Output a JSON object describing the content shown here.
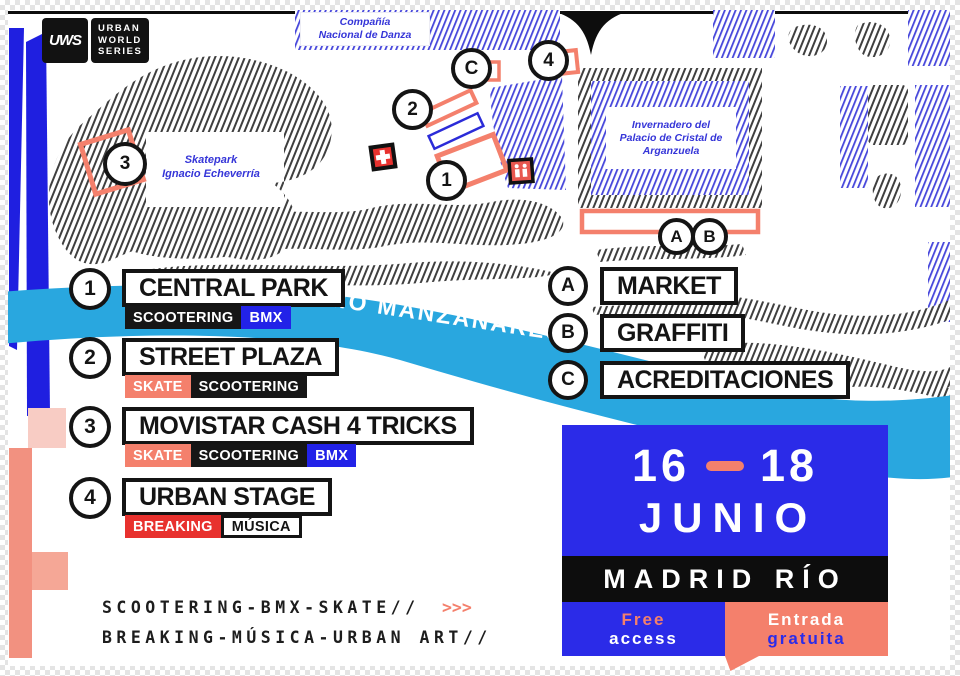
{
  "logo": {
    "monogram": "UWS",
    "line1": "URBAN",
    "line2": "WORLD",
    "line3": "SERIES"
  },
  "map": {
    "labels": {
      "danza": "Compañía\nNacional de Danza",
      "skatepark": "Skatepark\nIgnacio Echeverría",
      "invernadero": "Invernadero del\nPalacio de Cristal de\nArganzuela"
    },
    "markers": {
      "m1": "1",
      "m2": "2",
      "m3": "3",
      "m4": "4",
      "mA": "A",
      "mB": "B",
      "mC": "C"
    },
    "river_label": "RÍO MANZANARES",
    "icons": [
      "medical-cross",
      "restroom"
    ]
  },
  "legend_left": [
    {
      "num": "1",
      "name": "CENTRAL PARK",
      "tags": [
        {
          "label": "SCOOTERING",
          "color": "black"
        },
        {
          "label": "BMX",
          "color": "blue"
        }
      ]
    },
    {
      "num": "2",
      "name": "STREET PLAZA",
      "tags": [
        {
          "label": "SKATE",
          "color": "salmon"
        },
        {
          "label": "SCOOTERING",
          "color": "black"
        }
      ]
    },
    {
      "num": "3",
      "name": "MOVISTAR CASH 4 TRICKS",
      "tags": [
        {
          "label": "SKATE",
          "color": "salmon"
        },
        {
          "label": "SCOOTERING",
          "color": "black"
        },
        {
          "label": "BMX",
          "color": "blue"
        }
      ]
    },
    {
      "num": "4",
      "name": "URBAN STAGE",
      "tags": [
        {
          "label": "BREAKING",
          "color": "red"
        },
        {
          "label": "MÚSICA",
          "color": "white"
        }
      ]
    }
  ],
  "legend_right": [
    {
      "letter": "A",
      "name": "MARKET"
    },
    {
      "letter": "B",
      "name": "GRAFFITI"
    },
    {
      "letter": "C",
      "name": "ACREDITACIONES"
    }
  ],
  "event": {
    "day_start": "16",
    "dash": "–",
    "day_end": "18",
    "month": "JUNIO",
    "location": "MADRID RÍO",
    "free_line1": "Free",
    "free_line2": "access",
    "entry_line1": "Entrada",
    "entry_line2": "gratuita"
  },
  "footer": {
    "line1": "SCOOTERING-BMX-SKATE//",
    "arrows": ">>>",
    "line2": "BREAKING-MÚSICA-URBAN ART//"
  },
  "colors": {
    "blue": "#2B2BE8",
    "salmon": "#F4806C",
    "red": "#E8312E",
    "cyan": "#29A7DF",
    "black": "#141414",
    "lavender": "#4646DB"
  }
}
